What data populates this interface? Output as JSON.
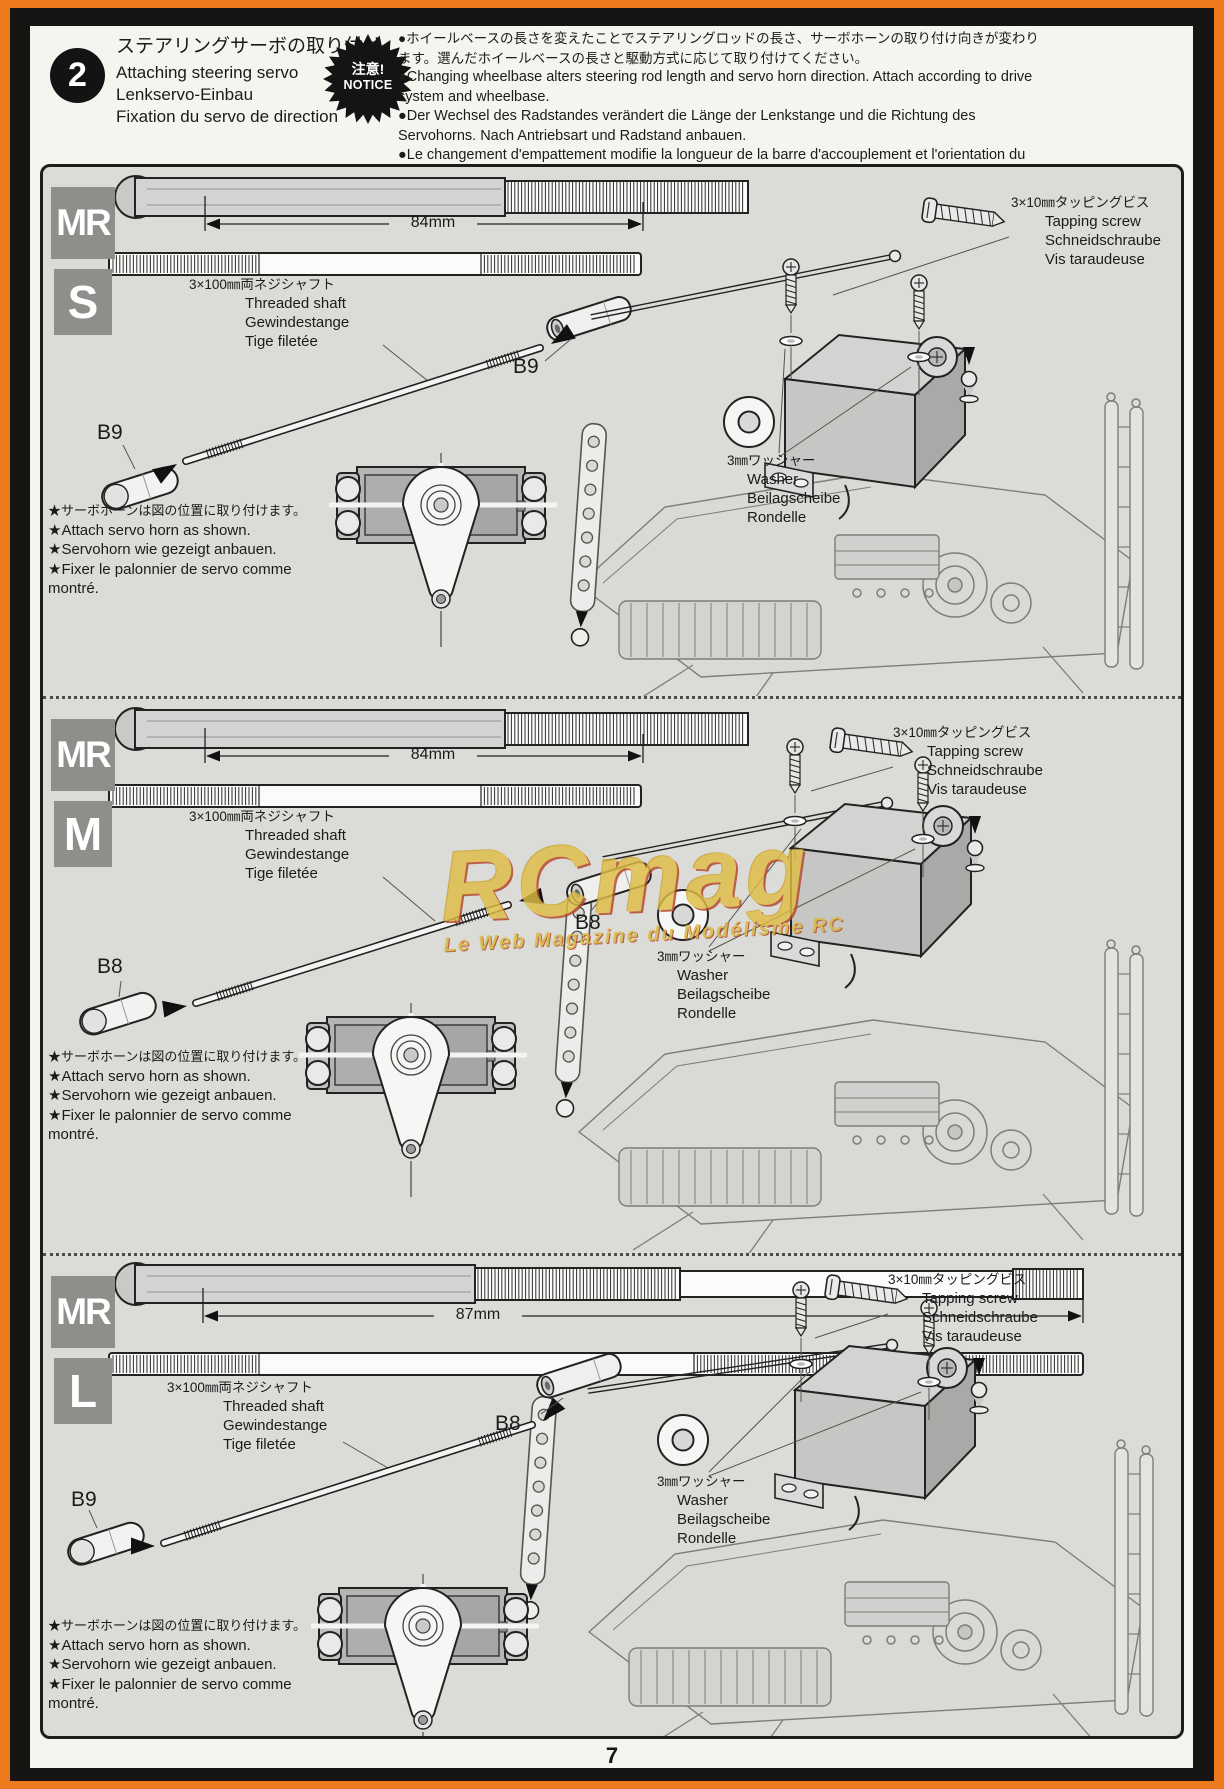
{
  "page": {
    "number": "7"
  },
  "header": {
    "step_number": "2",
    "title_ja": "ステアリングサーボの取り付け",
    "title_en": "Attaching steering servo",
    "title_de": "Lenkservo-Einbau",
    "title_fr": "Fixation du servo de direction",
    "notice_badge_ja": "注意!",
    "notice_badge_en": "NOTICE",
    "notice_ja": "●ホイールベースの長さを変えたことでステアリングロッドの長さ、サーボホーンの取り付け向きが変わります。選んだホイールベースの長さと駆動方式に応じて取り付けてください。",
    "notice_en": "●Changing wheelbase alters steering rod length and servo horn direction. Attach according to drive system and wheelbase.",
    "notice_de": "●Der Wechsel des Radstandes verändert die Länge der Lenkstange und die Richtung des Servohorns. Nach Antriebsart und Radstand anbauen.",
    "notice_fr": "●Le changement d'empattement modifie la longueur de la barre d'accouplement et l'orientation du palonnier de servo. Fixer en fonction du système de transmission et de l'empattement."
  },
  "labels": {
    "threaded_shaft_ja": "3×100㎜両ネジシャフト",
    "threaded_shaft_en": "Threaded shaft",
    "threaded_shaft_de": "Gewindestange",
    "threaded_shaft_fr": "Tige filetée",
    "tapping_screw_ja": "3×10㎜タッピングビス",
    "tapping_screw_en": "Tapping screw",
    "tapping_screw_de": "Schneidschraube",
    "tapping_screw_fr": "Vis taraudeuse",
    "washer_ja": "3㎜ワッシャー",
    "washer_en": "Washer",
    "washer_de": "Beilagscheibe",
    "washer_fr": "Rondelle",
    "horn_note_ja": "★サーボホーンは図の位置に取り付けます。",
    "horn_note_en": "★Attach servo horn as shown.",
    "horn_note_de": "★Servohorn wie gezeigt anbauen.",
    "horn_note_fr": "★Fixer le palonnier de servo comme montré."
  },
  "sections": [
    {
      "badge_top": "MR",
      "badge_size": "S",
      "dimension": "84mm",
      "part_right": "B9",
      "part_left": "B9"
    },
    {
      "badge_top": "MR",
      "badge_size": "M",
      "dimension": "84mm",
      "part_right": "B8",
      "part_left": "B8"
    },
    {
      "badge_top": "MR",
      "badge_size": "L",
      "dimension": "87mm",
      "part_right": "B8",
      "part_left": "B9"
    }
  ],
  "watermark": {
    "text": "RCmag",
    "subtext": "Le Web Magazine du Modélisme RC"
  }
}
